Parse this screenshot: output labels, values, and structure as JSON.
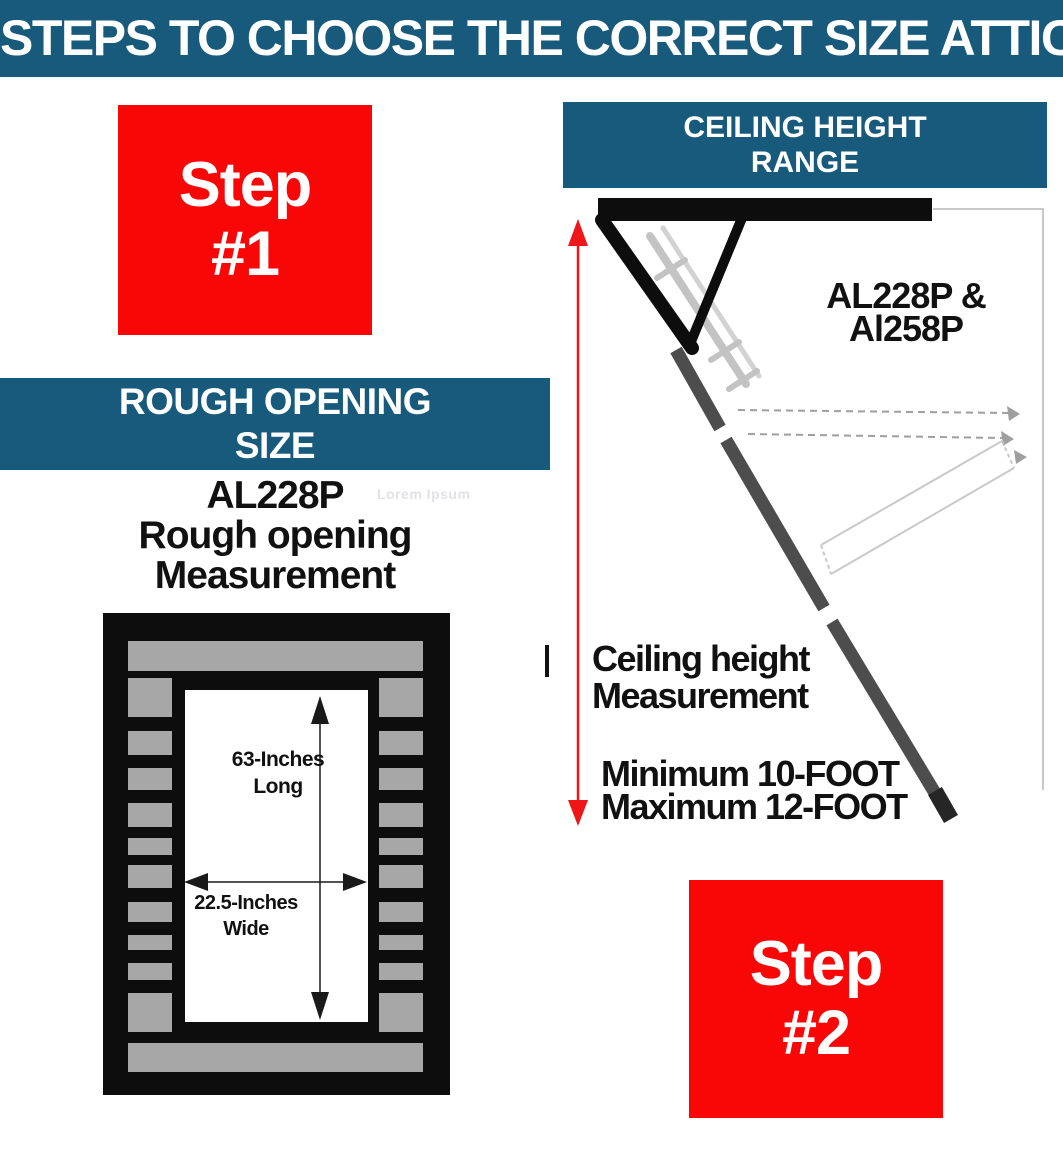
{
  "header": {
    "title": "STEPS TO CHOOSE THE CORRECT SIZE ATTIC"
  },
  "steps": {
    "step1": {
      "line1": "Step",
      "line2": "#1"
    },
    "step2": {
      "line1": "Step",
      "line2": "#2"
    }
  },
  "rough_opening": {
    "banner_line1": "ROUGH OPENING",
    "banner_line2": "SIZE",
    "model": "AL228P",
    "subtitle_line1": "Rough opening",
    "subtitle_line2": "Measurement",
    "watermark": "Lorem Ipsum",
    "length_label_line1": "63-Inches",
    "length_label_line2": "Long",
    "width_label_line1": "22.5-Inches",
    "width_label_line2": "Wide"
  },
  "ceiling_height": {
    "banner_line1": "CEILING HEIGHT",
    "banner_line2": "RANGE",
    "models_line1": "AL228P &",
    "models_line2": "Al258P",
    "measure_line1": "Ceiling height",
    "measure_line2": "Measurement",
    "range_line1": "Minimum 10-FOOT",
    "range_line2": "Maximum 12-FOOT"
  },
  "colors": {
    "teal": "#175A7C",
    "red": "#F90606",
    "arrow_red": "#EE1616",
    "ink": "#111111",
    "frame_black": "#0D0D0D",
    "block_gray": "#A7A7A7",
    "rail_dark": "#4D4D4D",
    "rail_tip": "#262626",
    "ladder_light": "#C3C3C3",
    "ladder_light2": "#D2D2D2",
    "ghost_gray": "#C9C9C9",
    "dash_gray": "#9F9F9F",
    "watermark_gray": "#E1E1E9"
  }
}
